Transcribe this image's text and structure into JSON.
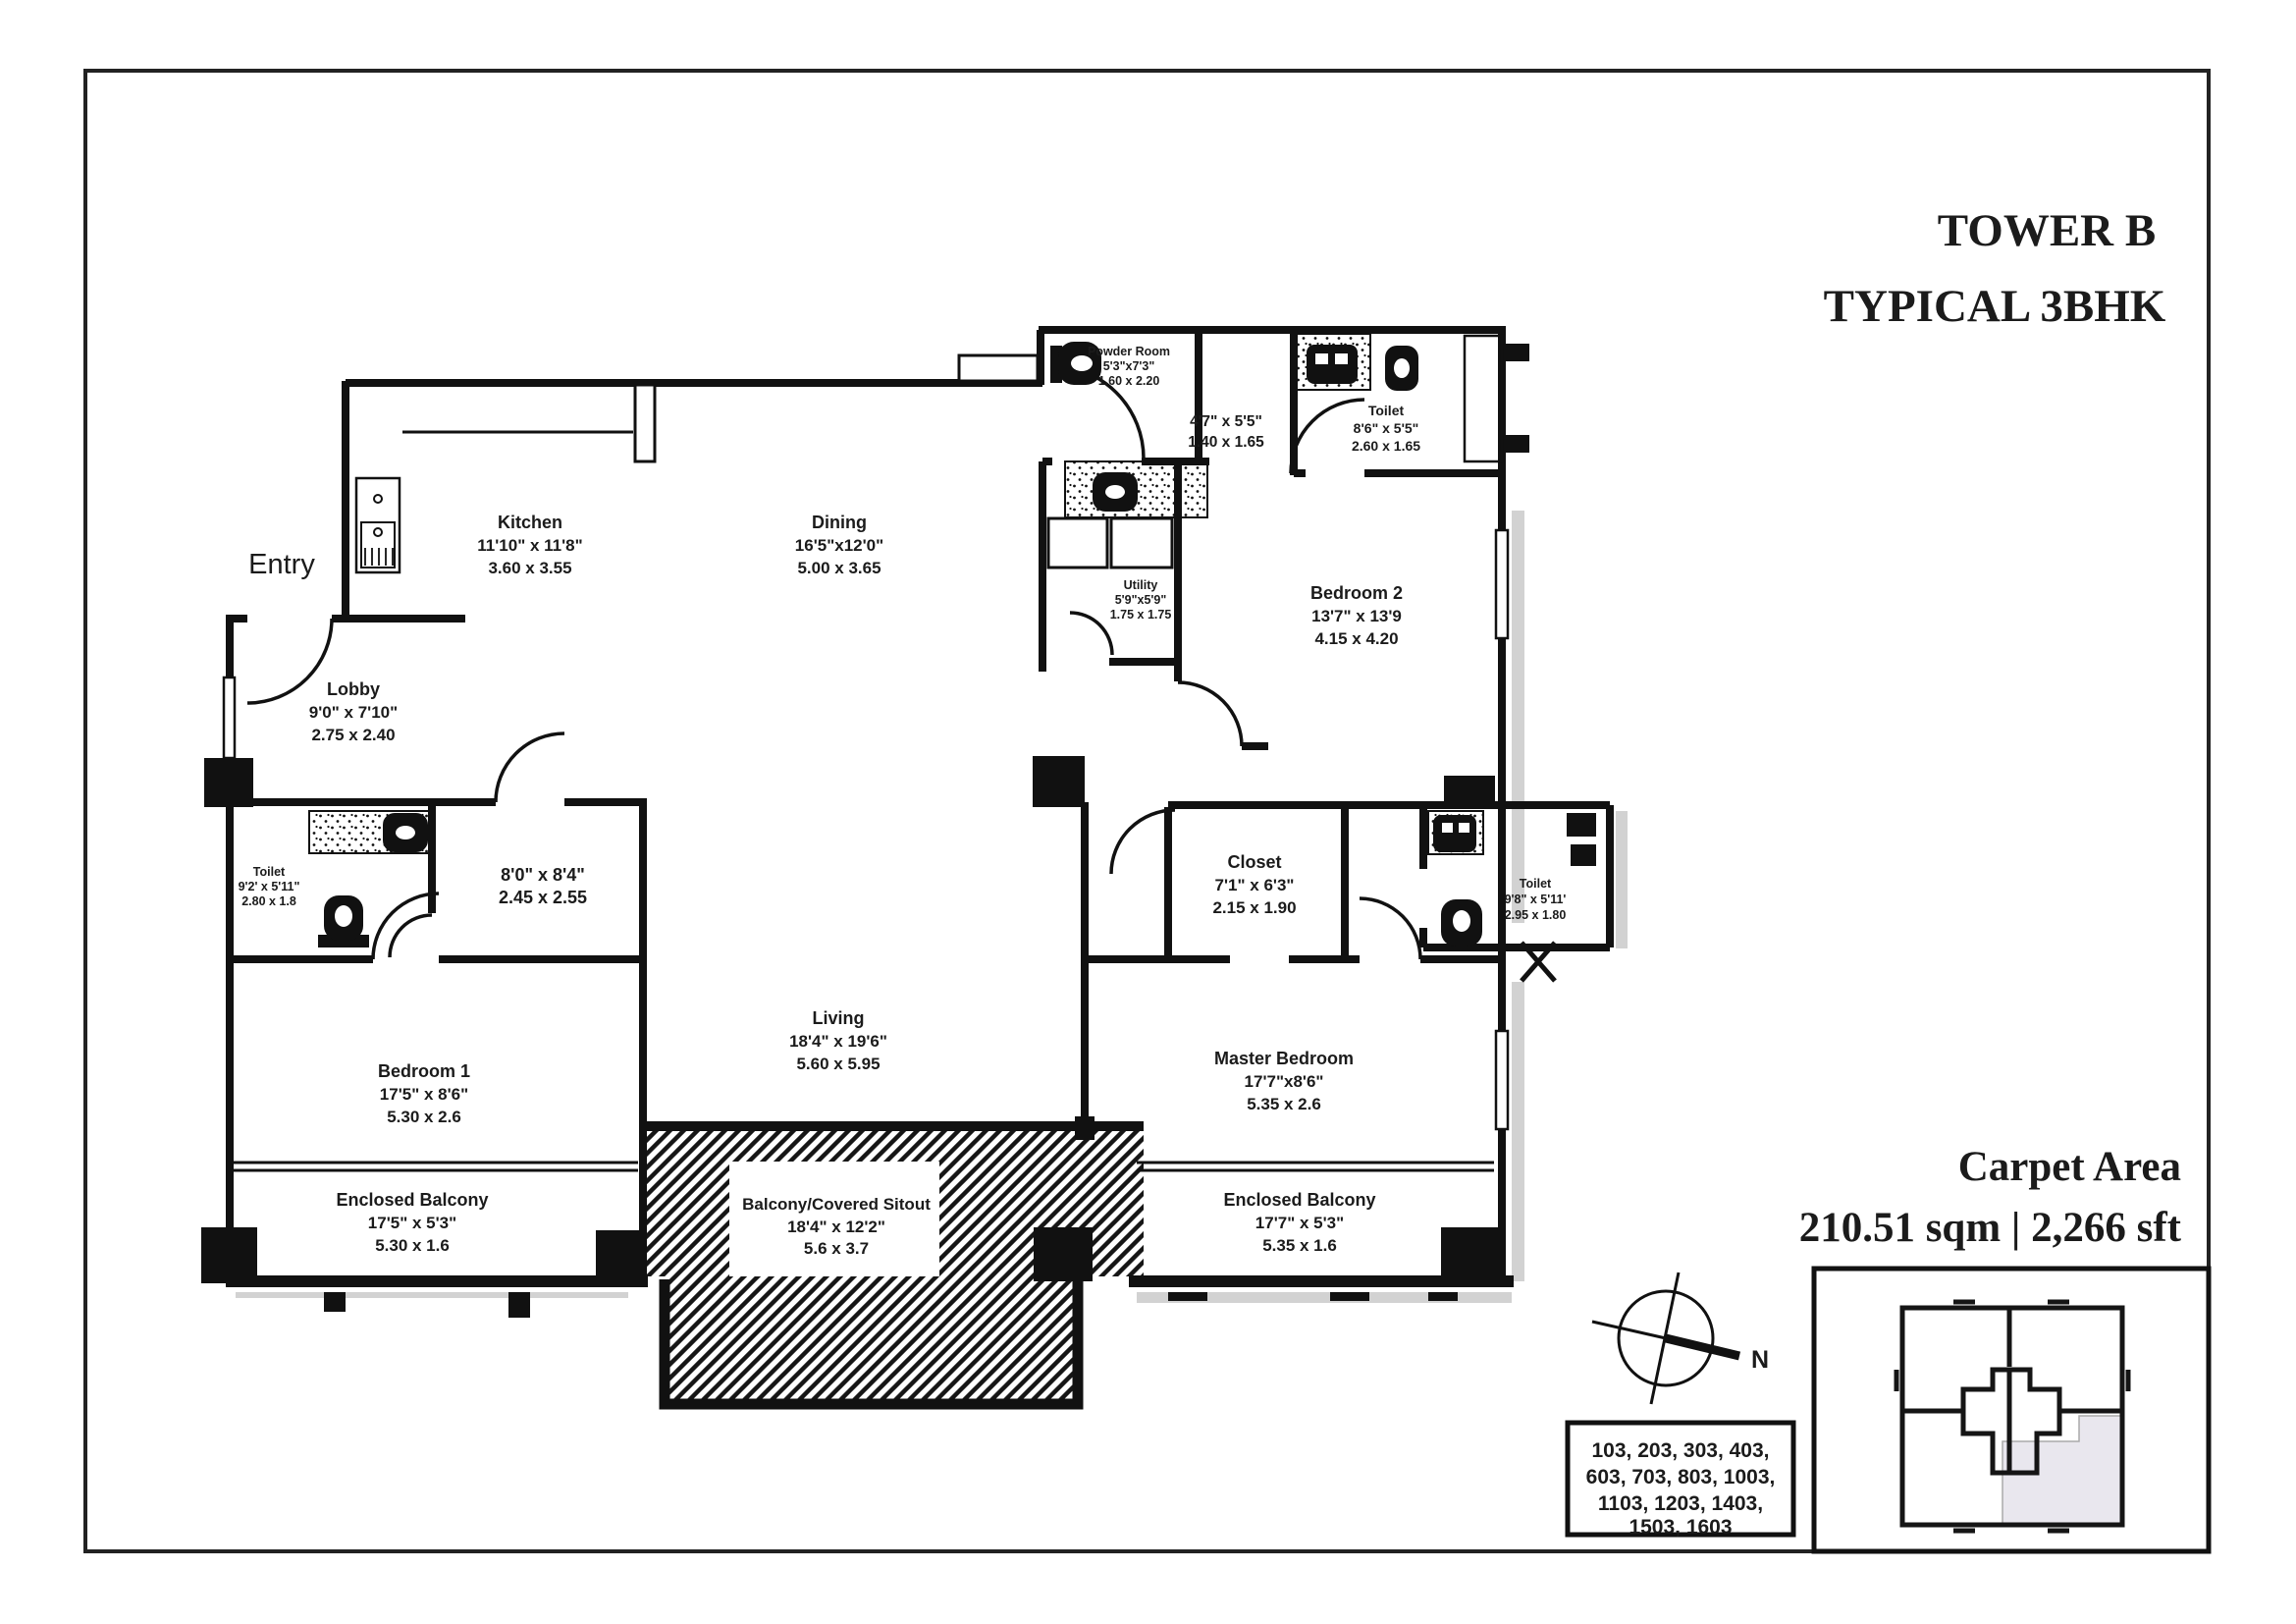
{
  "header": {
    "title_line1": "TOWER B",
    "title_line2": "TYPICAL 3BHK"
  },
  "entry_label": "Entry",
  "compass": {
    "north_label": "N"
  },
  "carpet_area": {
    "label": "Carpet Area",
    "value": "210.51 sqm | 2,266 sft"
  },
  "unit_numbers": {
    "line1": "103, 203, 303, 403,",
    "line2": "603, 703, 803, 1003,",
    "line3": "1103, 1203, 1403,",
    "line4": "1503, 1603"
  },
  "rooms": {
    "kitchen": {
      "name": "Kitchen",
      "imperial": "11'10\" x 11'8\"",
      "metric": "3.60 x 3.55"
    },
    "dining": {
      "name": "Dining",
      "imperial": "16'5\"x12'0\"",
      "metric": "5.00 x 3.65"
    },
    "powder_room": {
      "name": "Powder Room",
      "imperial": "5'3\"x7'3\"",
      "metric": "1.60 x 2.20"
    },
    "passage": {
      "imperial": "4'7\" x 5'5\"",
      "metric": "1.40 x 1.65"
    },
    "toilet_bed2": {
      "name": "Toilet",
      "imperial": "8'6\" x 5'5\"",
      "metric": "2.60 x 1.65"
    },
    "utility": {
      "name": "Utility",
      "imperial": "5'9\"x5'9\"",
      "metric": "1.75 x 1.75"
    },
    "bedroom2": {
      "name": "Bedroom 2",
      "imperial": "13'7\" x 13'9",
      "metric": "4.15 x 4.20"
    },
    "lobby": {
      "name": "Lobby",
      "imperial": "9'0\" x 7'10\"",
      "metric": "2.75 x 2.40"
    },
    "toilet_bed1": {
      "name": "Toilet",
      "imperial": "9'2' x 5'11\"",
      "metric": "2.80 x 1.8"
    },
    "dress_bed1": {
      "imperial": "8'0\" x 8'4\"",
      "metric": "2.45 x 2.55"
    },
    "bedroom1": {
      "name": "Bedroom 1",
      "imperial": "17'5\" x 8'6\"",
      "metric": "5.30 x 2.6"
    },
    "living": {
      "name": "Living",
      "imperial": "18'4\" x 19'6\"",
      "metric": "5.60 x 5.95"
    },
    "sitout": {
      "name": "Balcony/Covered Sitout",
      "imperial": "18'4\" x 12'2\"",
      "metric": "5.6 x 3.7"
    },
    "closet": {
      "name": "Closet",
      "imperial": "7'1\" x 6'3\"",
      "metric": "2.15 x 1.90"
    },
    "toilet_master": {
      "name": "Toilet",
      "imperial": "9'8\" x 5'11'",
      "metric": "2.95 x 1.80"
    },
    "master_bedroom": {
      "name": "Master Bedroom",
      "imperial": "17'7\"x8'6\"",
      "metric": "5.35 x 2.6"
    },
    "balcony_left": {
      "name": "Enclosed Balcony",
      "imperial": "17'5\" x 5'3\"",
      "metric": "5.30 x 1.6"
    },
    "balcony_right": {
      "name": "Enclosed Balcony",
      "imperial": "17'7\" x 5'3\"",
      "metric": "5.35 x 1.6"
    }
  },
  "colors": {
    "ink": "#1b1b1b",
    "shadow": "#d2d2d2",
    "keyplan_highlight": "#e9e7ee"
  }
}
